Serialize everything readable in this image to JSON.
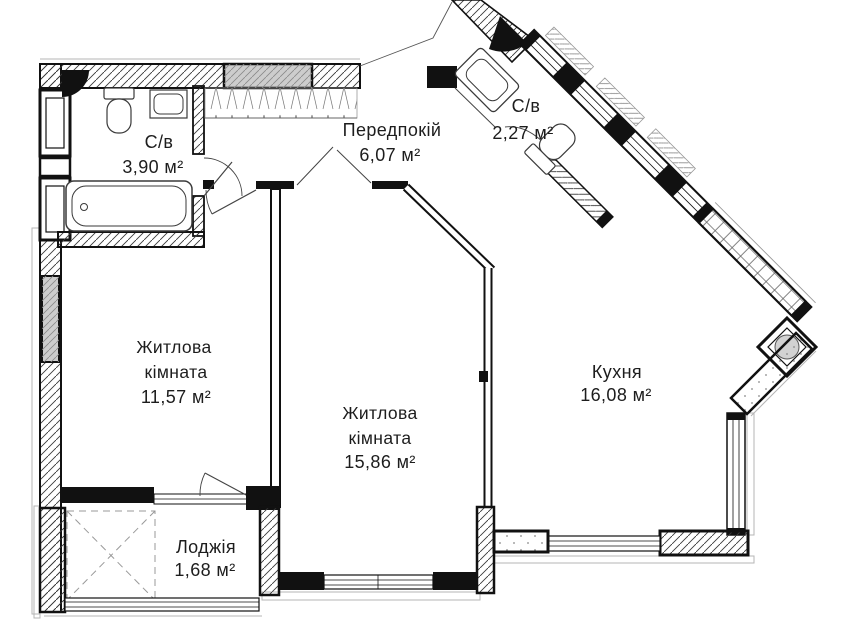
{
  "rooms": [
    {
      "key": "bathroom-1",
      "name": "С/в",
      "area": "3,90 м²"
    },
    {
      "key": "hallway",
      "name": "Передпокій",
      "area": "6,07 м²"
    },
    {
      "key": "bathroom-2",
      "name": "С/в",
      "area": "2,27 м²"
    },
    {
      "key": "living-1",
      "name_line1": "Житлова",
      "name_line2": "кімната",
      "area": "11,57 м²"
    },
    {
      "key": "living-2",
      "name_line1": "Житлова",
      "name_line2": "кімната",
      "area": "15,86 м²"
    },
    {
      "key": "kitchen",
      "name": "Кухня",
      "area": "16,08 м²"
    },
    {
      "key": "loggia",
      "name": "Лоджія",
      "area": "1,68 м²"
    }
  ],
  "colors": {
    "wall": "#111111",
    "thin_line": "#333333",
    "window_fill": "#cdcdcd",
    "sill": "#aaaaaa",
    "text": "#1d1d1d",
    "background": "#ffffff"
  }
}
